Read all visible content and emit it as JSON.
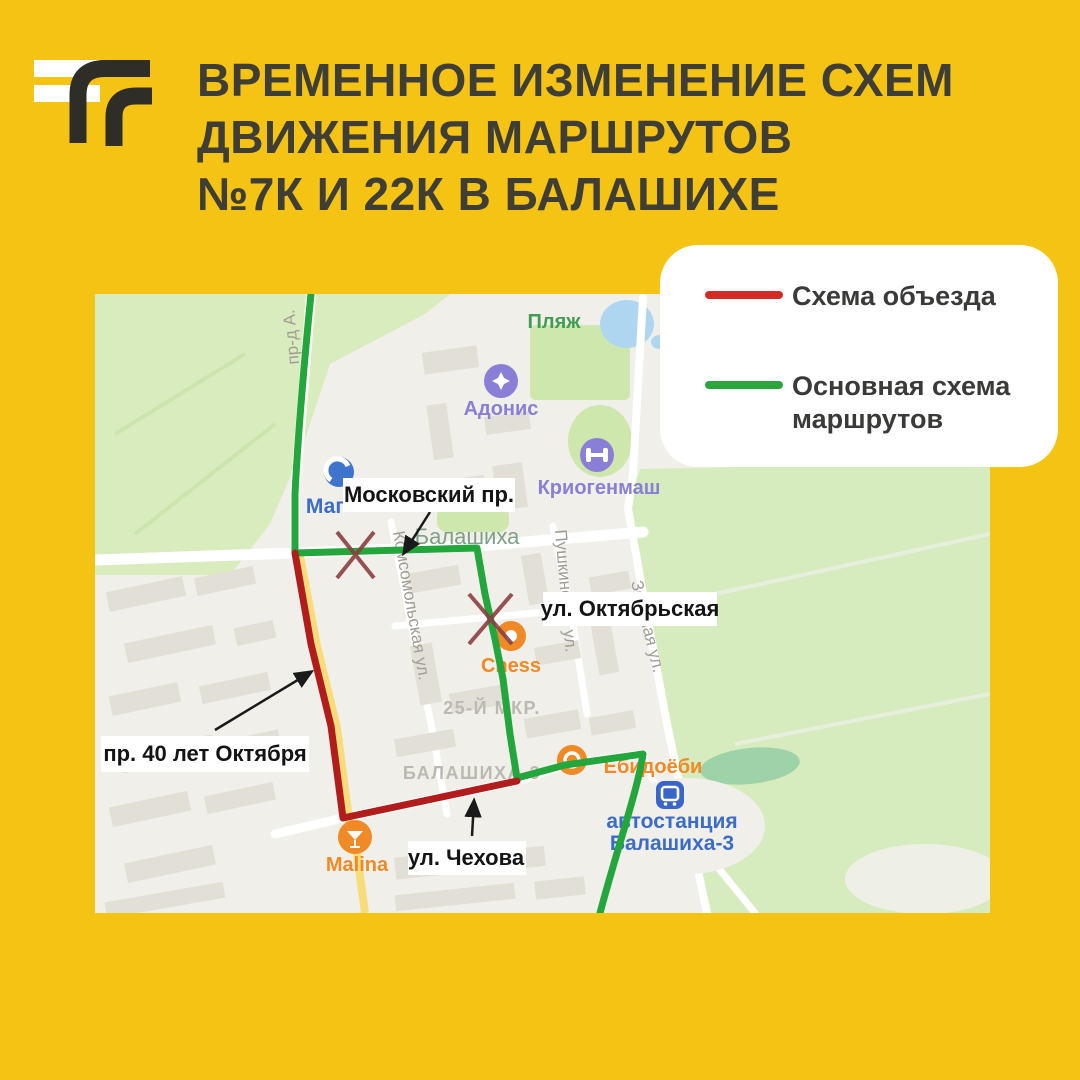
{
  "page": {
    "background": "#F5C313"
  },
  "title": {
    "line1": "ВРЕМЕННОЕ ИЗМЕНЕНИЕ СХЕМ",
    "line2": "ДВИЖЕНИЯ МАРШРУТОВ",
    "line3": "№7К И 22К В БАЛАШИХЕ"
  },
  "legend": {
    "detour": {
      "label": "Схема объезда",
      "color": "#D32B25"
    },
    "main": {
      "label_line1": "Основная схема",
      "label_line2": "маршрутов",
      "color": "#2BA53C"
    }
  },
  "map": {
    "routes": {
      "detour_color": "#B11D1D",
      "main_color": "#23A63C"
    },
    "callouts": {
      "moskovsky_prospekt": "Московский пр.",
      "oktyabrskaya": "ул. Октябрьская",
      "pr_40_let_oktyabrya": "пр. 40 лет Октября",
      "chekhova": "ул. Чехова"
    },
    "streets": {
      "komsomolskaya": "Комсомольская ул.",
      "pushkinskaya": "Пушкинская ул.",
      "zelenaya": "Зелёная ул.",
      "proezd": "пр-д А.",
      "city": "Балашиха",
      "district_25": "25-Й МКР.",
      "district_balashikha3": "БАЛАШИХА-3"
    },
    "pois": {
      "plyazh": "Пляж",
      "adonis": "Адонис",
      "kriogenmash": "Криогенмаш",
      "magnit": "Маг",
      "chess": "Chess",
      "yobidoyobi": "Ёбидоёби",
      "bus_station_line1": "автостанция",
      "bus_station_line2": "Балашиха-3",
      "malina": "Malina"
    }
  }
}
